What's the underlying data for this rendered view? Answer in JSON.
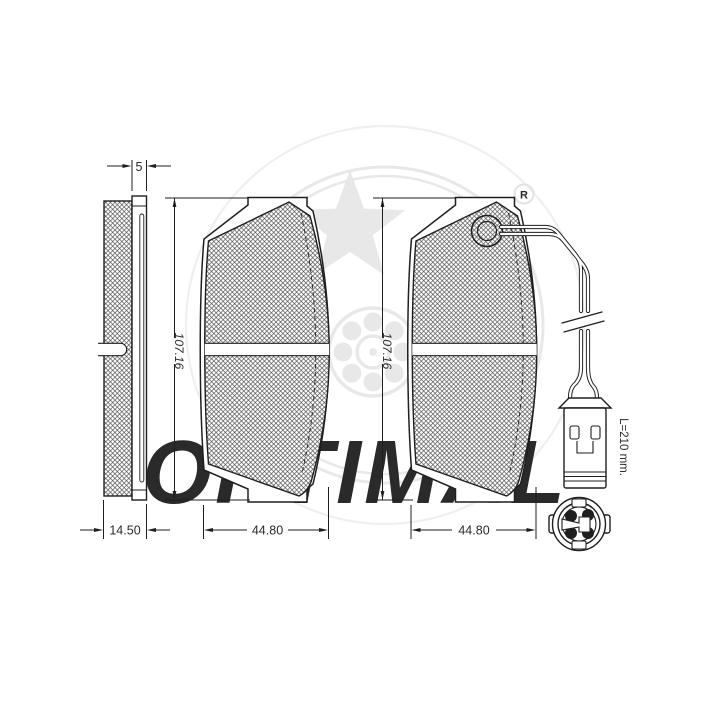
{
  "watermark": {
    "brand_wordmark": "OPTIMAL",
    "registered_symbol": "R"
  },
  "drawing": {
    "side_view": {
      "plate_thickness_label": "5",
      "pad_thickness_label": "14.50"
    },
    "pad_front_left": {
      "height_label": "107.16",
      "width_label": "44.80"
    },
    "pad_front_right": {
      "height_label": "107.16",
      "width_label": "44.80"
    },
    "wear_sensor": {
      "wire_length_label": "L=210 mm."
    }
  },
  "colors": {
    "background": "#ffffff",
    "line": "#1f1f1f",
    "hatch_line": "#4a4a4a",
    "watermark": "#e8e8e8",
    "dimension_text": "#2a2a2a"
  }
}
